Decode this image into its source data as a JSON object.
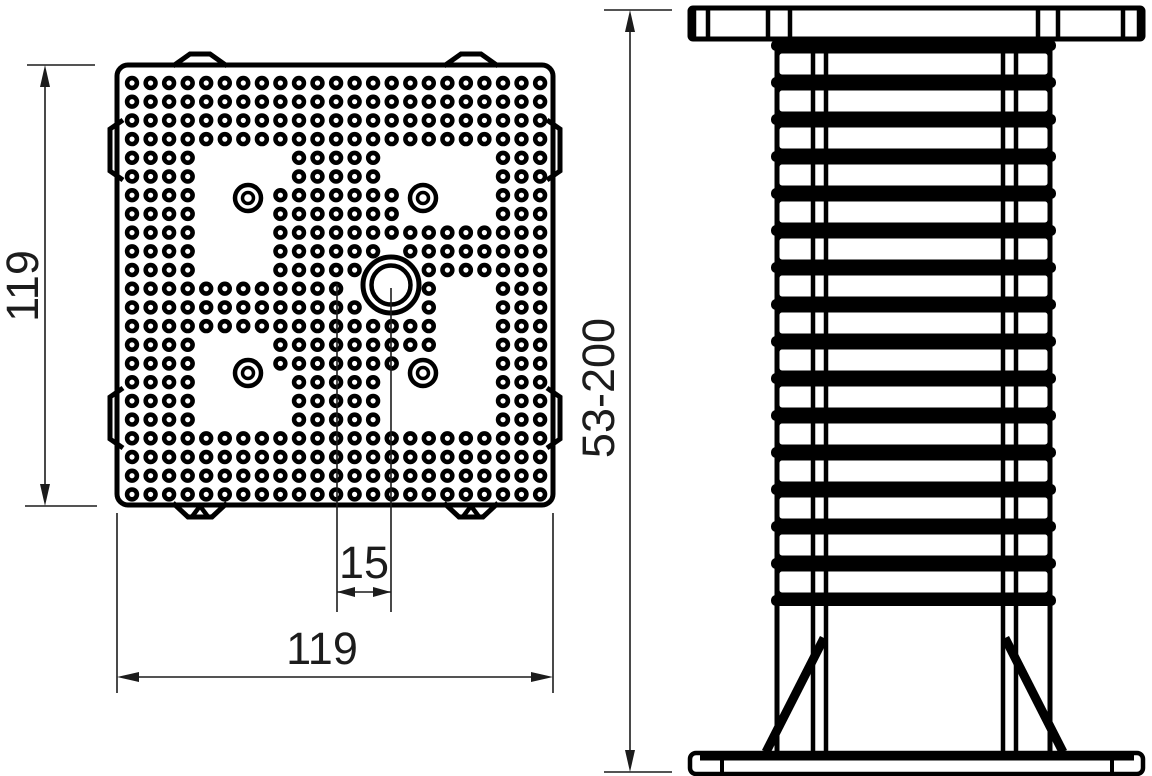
{
  "drawing": {
    "top_view": {
      "plate_height_label": "119",
      "plate_width_label": "119",
      "hole_offset_label": "15"
    },
    "side_view": {
      "height_range_label": "53-200"
    },
    "colors": {
      "ink": "#000000",
      "dim_line": "#1c1c1c",
      "background": "#ffffff"
    }
  }
}
